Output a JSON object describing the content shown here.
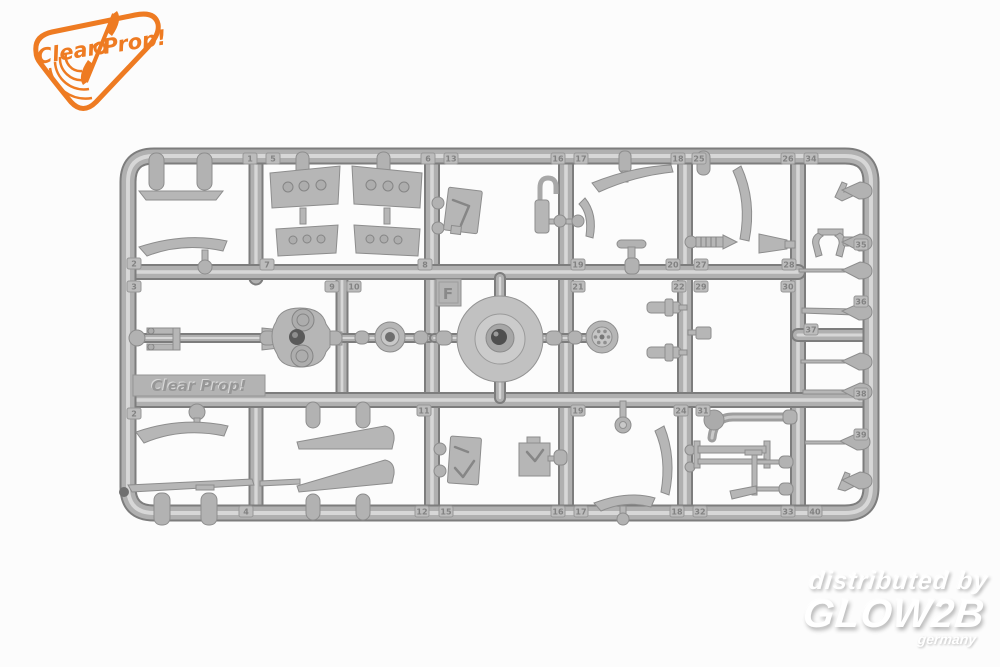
{
  "brand_badge": {
    "word1": "Clear",
    "word2": "Prop!",
    "color": "#ee7b22"
  },
  "sprue": {
    "plastic_color": "#b4b4b4",
    "molded_logo": "Clear Prop!",
    "letter": "F",
    "part_tabs": [
      {
        "n": "1",
        "x": 243,
        "y": 153
      },
      {
        "n": "5",
        "x": 266,
        "y": 153
      },
      {
        "n": "6",
        "x": 421,
        "y": 153
      },
      {
        "n": "13",
        "x": 444,
        "y": 153
      },
      {
        "n": "16",
        "x": 551,
        "y": 153
      },
      {
        "n": "17",
        "x": 574,
        "y": 153
      },
      {
        "n": "18",
        "x": 671,
        "y": 153
      },
      {
        "n": "25",
        "x": 692,
        "y": 153
      },
      {
        "n": "26",
        "x": 781,
        "y": 153
      },
      {
        "n": "34",
        "x": 804,
        "y": 153
      },
      {
        "n": "2",
        "x": 127,
        "y": 258
      },
      {
        "n": "3",
        "x": 127,
        "y": 281
      },
      {
        "n": "2",
        "x": 127,
        "y": 408
      },
      {
        "n": "7",
        "x": 260,
        "y": 259
      },
      {
        "n": "8",
        "x": 418,
        "y": 259
      },
      {
        "n": "19",
        "x": 571,
        "y": 259
      },
      {
        "n": "20",
        "x": 666,
        "y": 259
      },
      {
        "n": "27",
        "x": 694,
        "y": 259
      },
      {
        "n": "28",
        "x": 782,
        "y": 259
      },
      {
        "n": "9",
        "x": 325,
        "y": 281
      },
      {
        "n": "10",
        "x": 347,
        "y": 281
      },
      {
        "n": "21",
        "x": 571,
        "y": 281
      },
      {
        "n": "22",
        "x": 672,
        "y": 281
      },
      {
        "n": "29",
        "x": 694,
        "y": 281
      },
      {
        "n": "30",
        "x": 781,
        "y": 281
      },
      {
        "n": "11",
        "x": 417,
        "y": 405
      },
      {
        "n": "19",
        "x": 571,
        "y": 405
      },
      {
        "n": "24",
        "x": 674,
        "y": 405
      },
      {
        "n": "31",
        "x": 696,
        "y": 405
      },
      {
        "n": "4",
        "x": 239,
        "y": 506
      },
      {
        "n": "12",
        "x": 415,
        "y": 506
      },
      {
        "n": "15",
        "x": 439,
        "y": 506
      },
      {
        "n": "16",
        "x": 551,
        "y": 506
      },
      {
        "n": "17",
        "x": 574,
        "y": 506
      },
      {
        "n": "18",
        "x": 670,
        "y": 506
      },
      {
        "n": "32",
        "x": 693,
        "y": 506
      },
      {
        "n": "33",
        "x": 781,
        "y": 506
      },
      {
        "n": "40",
        "x": 808,
        "y": 506
      },
      {
        "n": "35",
        "x": 854,
        "y": 239
      },
      {
        "n": "36",
        "x": 854,
        "y": 296
      },
      {
        "n": "37",
        "x": 804,
        "y": 324
      },
      {
        "n": "38",
        "x": 854,
        "y": 388
      },
      {
        "n": "39",
        "x": 854,
        "y": 429
      }
    ]
  },
  "watermark": {
    "line1": "distributed by",
    "brand": "GLOW2B",
    "country": "germany",
    "color": "#ffffff"
  }
}
